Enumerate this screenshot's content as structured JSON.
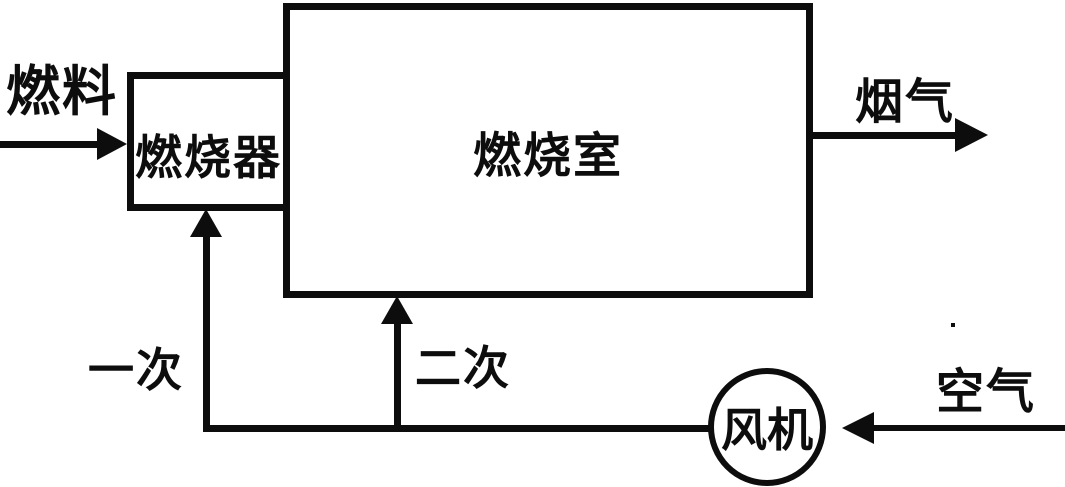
{
  "diagram": {
    "type": "process-flow",
    "background_color": "#ffffff",
    "stroke_color": "#0d0d0d",
    "nodes": {
      "burner": {
        "label": "燃烧器",
        "shape": "rect"
      },
      "chamber": {
        "label": "燃烧室",
        "shape": "rect"
      },
      "fan": {
        "label": "风机",
        "shape": "circle"
      }
    },
    "streams": {
      "fuel": {
        "label": "燃料",
        "direction": "right",
        "to": "burner"
      },
      "flue_gas": {
        "label": "烟气",
        "direction": "right",
        "from": "chamber"
      },
      "primary_air": {
        "label": "一次",
        "direction": "up",
        "from": "fan",
        "to": "burner"
      },
      "secondary_air": {
        "label": "二次",
        "direction": "up",
        "from": "fan",
        "to": "chamber"
      },
      "air": {
        "label": "空气",
        "direction": "left",
        "to": "fan"
      }
    }
  }
}
